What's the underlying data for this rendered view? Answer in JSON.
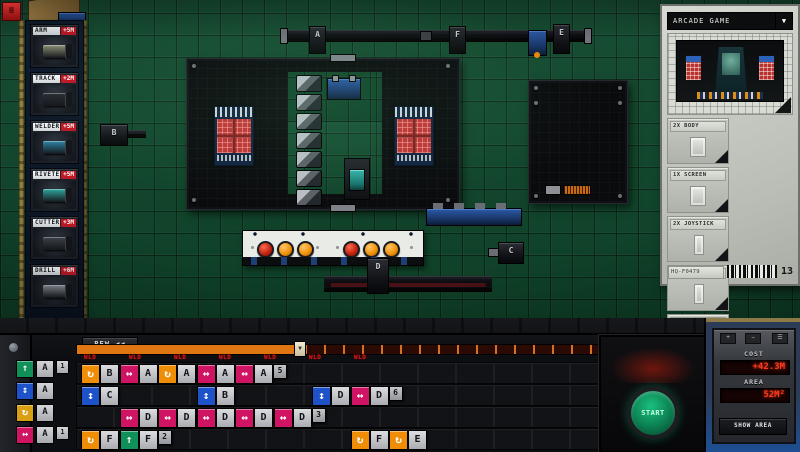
{
  "hud": {
    "menu_icon": "≡"
  },
  "sidebar": {
    "items": [
      {
        "label": "ARM",
        "price": "+5M",
        "color": "#8d9378"
      },
      {
        "label": "TRACK",
        "price": "+2M",
        "color": "#2a2e35"
      },
      {
        "label": "WELDER",
        "price": "+5M",
        "color": "#2f86a8"
      },
      {
        "label": "RIVETER",
        "price": "+5M",
        "color": "#2fa8a0"
      },
      {
        "label": "CUTTER",
        "price": "+3M",
        "color": "#41464e"
      },
      {
        "label": "DRILL",
        "price": "+6M",
        "color": "#9297a0"
      }
    ]
  },
  "floor": {
    "carriages": [
      {
        "id": "A",
        "x": 309,
        "y": 26,
        "w": 15,
        "h": 26
      },
      {
        "id": "F",
        "x": 449,
        "y": 26,
        "w": 15,
        "h": 26
      },
      {
        "id": "E",
        "x": 553,
        "y": 24,
        "w": 15,
        "h": 28
      },
      {
        "id": "B",
        "x": 100,
        "y": 124,
        "w": 26,
        "h": 20
      },
      {
        "id": "C",
        "x": 498,
        "y": 242,
        "w": 24,
        "h": 20
      },
      {
        "id": "D",
        "x": 367,
        "y": 258,
        "w": 20,
        "h": 34
      }
    ],
    "control_buttons": [
      "red",
      "orange",
      "orange",
      "red",
      "orange",
      "orange"
    ]
  },
  "blueprint": {
    "title": "ARCADE GAME",
    "dropdown_icon": "▼",
    "parts": [
      {
        "name": "2X BODY"
      },
      {
        "name": "1X SCREEN"
      },
      {
        "name": "2X JOYSTICK"
      },
      {
        "name": "4X BUTTON"
      },
      {
        "name": "4X PANEL"
      }
    ],
    "serial": "HQ-F0479",
    "count": "13"
  },
  "deck": {
    "rew_label": "REW ◀◀",
    "skip_label": "SKIP ▶▶",
    "start_label": "START",
    "playhead_icon": "▼",
    "legend": [
      {
        "type": "up",
        "labels": [
          "A",
          "1"
        ]
      },
      {
        "type": "vert",
        "labels": [
          "A"
        ]
      },
      {
        "type": "rotate2",
        "labels": [
          "A"
        ]
      },
      {
        "type": "move",
        "labels": [
          "A",
          "1"
        ]
      }
    ],
    "markers": [
      "WLD",
      "WLD",
      "WLD",
      "WLD",
      "WLD",
      "WLD",
      "WLD"
    ],
    "chip_colors": {
      "rotate": "#ef8e06",
      "rotate2": "#d8a012",
      "move": "#d01464",
      "vert": "#1d52c8",
      "up": "#12905a"
    },
    "chip_glyphs": {
      "rotate": "↻",
      "rotate2": "↻",
      "move": "↔",
      "vert": "↕",
      "up": "↑"
    },
    "rows": [
      {
        "chips": [
          {
            "slot": 0,
            "type": "rotate",
            "labels": [
              "B"
            ]
          },
          {
            "slot": 1,
            "type": "move",
            "labels": [
              "A",
              "3"
            ]
          },
          {
            "slot": 2,
            "type": "rotate",
            "labels": [
              "A"
            ]
          },
          {
            "slot": 3,
            "type": "move",
            "labels": [
              "A",
              "4"
            ]
          },
          {
            "slot": 4,
            "type": "move",
            "labels": [
              "A",
              "5"
            ]
          }
        ]
      },
      {
        "chips": [
          {
            "slot": 0,
            "type": "vert",
            "labels": [
              "C"
            ]
          },
          {
            "slot": 3,
            "type": "vert",
            "labels": [
              "B"
            ]
          },
          {
            "slot": 6,
            "type": "vert",
            "labels": [
              "D"
            ]
          },
          {
            "slot": 7,
            "type": "move",
            "labels": [
              "D",
              "6"
            ]
          }
        ]
      },
      {
        "chips": [
          {
            "slot": 1,
            "type": "move",
            "labels": [
              "D",
              "3"
            ]
          },
          {
            "slot": 2,
            "type": "move",
            "labels": [
              "D",
              "3"
            ]
          },
          {
            "slot": 3,
            "type": "move",
            "labels": [
              "D",
              "4"
            ]
          },
          {
            "slot": 4,
            "type": "move",
            "labels": [
              "D",
              "5"
            ]
          },
          {
            "slot": 5,
            "type": "move",
            "labels": [
              "D",
              "3"
            ]
          }
        ]
      },
      {
        "chips": [
          {
            "slot": 0,
            "type": "rotate",
            "labels": [
              "F"
            ]
          },
          {
            "slot": 1,
            "type": "up",
            "labels": [
              "F",
              "2"
            ]
          },
          {
            "slot": 7,
            "type": "rotate",
            "labels": [
              "F"
            ]
          },
          {
            "slot": 8,
            "type": "rotate",
            "labels": [
              "E"
            ]
          }
        ]
      }
    ]
  },
  "pod": {
    "icons": [
      "+",
      "−",
      "☰"
    ],
    "cost_label": "COST",
    "cost_value": "+42.3M",
    "area_label": "AREA",
    "area_value": "52M²",
    "show_area_label": "SHOW AREA"
  }
}
